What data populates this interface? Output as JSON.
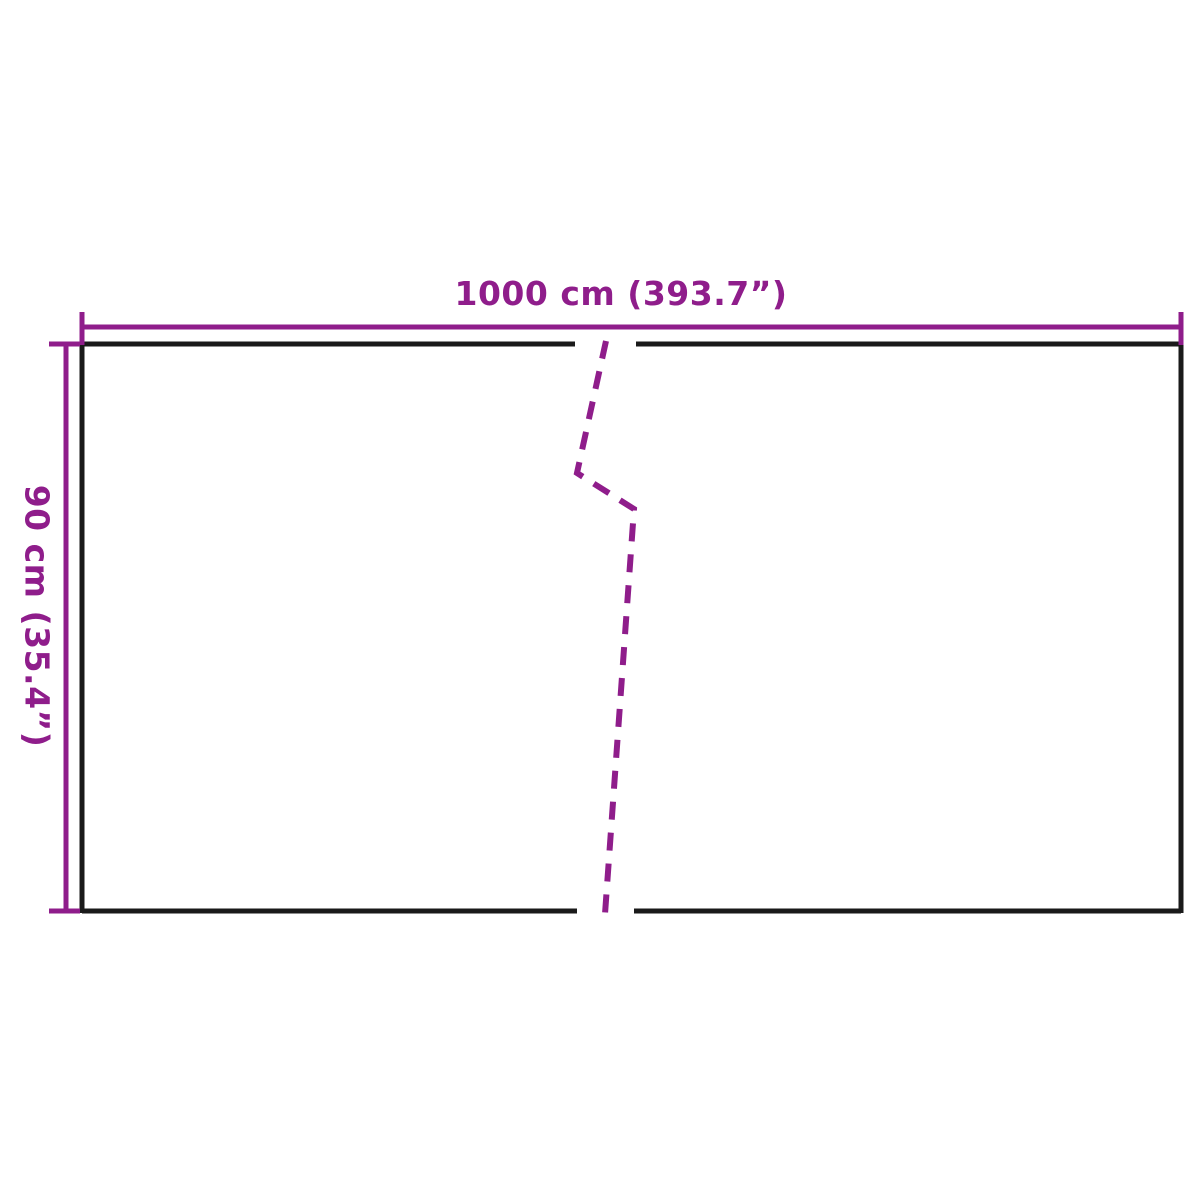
{
  "diagram": {
    "type": "product-dimension-diagram",
    "width_label": "1000 cm (393.7”)",
    "height_label": "90 cm (35.4”)",
    "dimensions": {
      "width_cm": 1000,
      "width_inches": 393.7,
      "height_cm": 90,
      "height_inches": 35.4
    },
    "colors": {
      "dimension": "#8f1d8b",
      "outline": "#1a1a1a",
      "background": "#ffffff"
    }
  }
}
